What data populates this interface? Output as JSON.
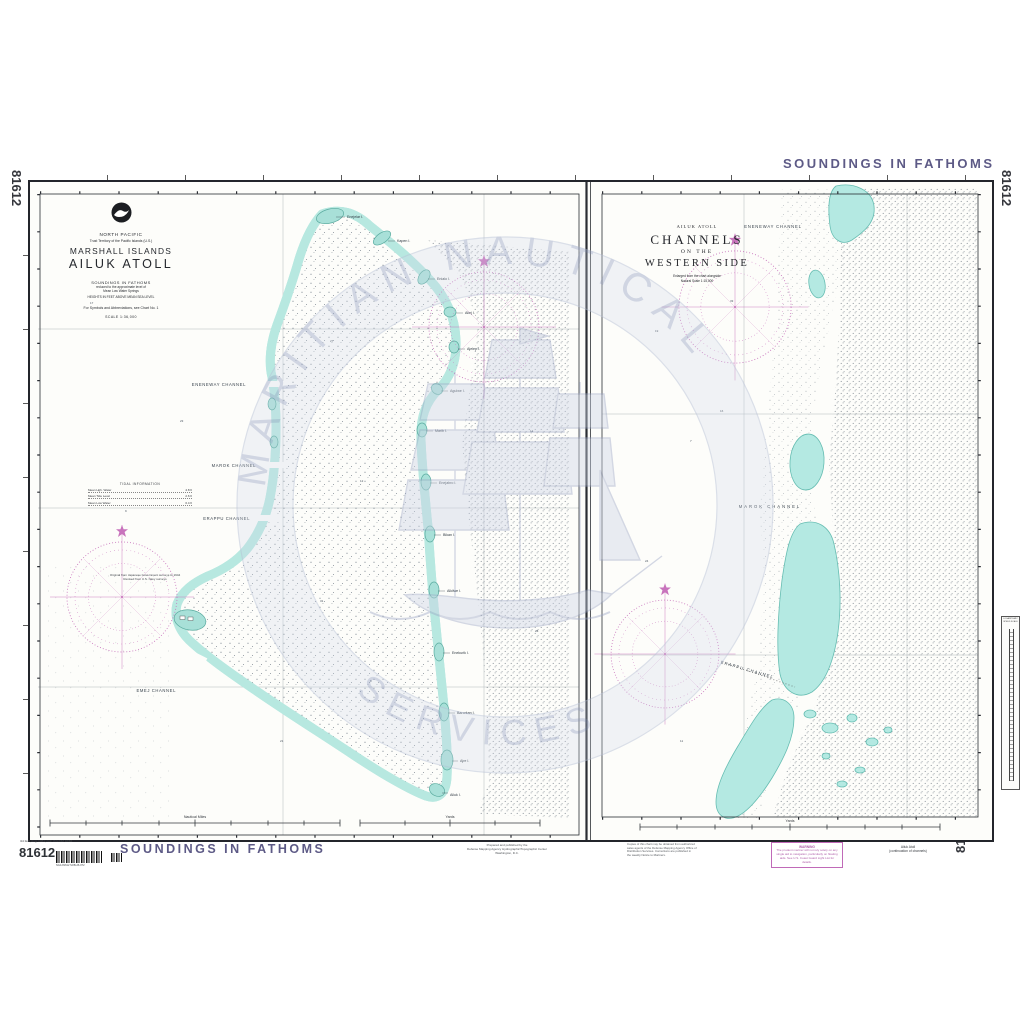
{
  "page": {
    "chart_number": "81612",
    "soundings_top": "SOUNDINGS IN FATHOMS",
    "soundings_bottom": "SOUNDINGS IN FATHOMS",
    "edition_note": "3rd Ed., Aug. 1984; corr. thru NM 32/84",
    "barcode_text": "NGA 81612 SOB-26-072"
  },
  "watermark": {
    "arc_top": "MARITIAN NAUTICAL",
    "arc_bottom": "SERVICES"
  },
  "left_panel": {
    "region": "NORTH PACIFIC",
    "territory": "Trust Territory of the Pacific Islands (U.S.)",
    "island_group": "MARSHALL ISLANDS",
    "title": "AILUK ATOLL",
    "soundings_note": "SOUNDINGS IN FATHOMS",
    "datum_note_1": "reduced to the approximate level of",
    "datum_note_2": "Mean Low Water Springs",
    "heights_note": "HEIGHTS IN FEET ABOVE MEAN SEA LEVEL",
    "symbols_note": "For Symbols and Abbreviations, see Chart No. 1",
    "scale_note": "SCALE 1:36,000",
    "tidal_table": {
      "title": "TIDAL INFORMATION",
      "rows": [
        {
          "label": "Mean Hgh. Water",
          "value": "4.8 ft"
        },
        {
          "label": "Mean Tide Level",
          "value": "2.6 ft"
        },
        {
          "label": "Mean Low Water",
          "value": "0.4 ft"
        }
      ]
    },
    "source_note_1": "Original from Japanese Government surveys to 1944",
    "source_note_2": "Revised from U.S. Navy surveys",
    "channels": [
      "ENENEWAY CHANNEL",
      "MAROK CHANNEL",
      "ERAPPU CHANNEL",
      "EMEJ CHANNEL"
    ],
    "islets": [
      "Enejelar I.",
      "Kapen I.",
      "Enialo I.",
      "Aliej I.",
      "Ajelep I.",
      "Agulwe I.",
      "Marib I.",
      "Enejabro I.",
      "Bikan I.",
      "Alkilwe I.",
      "Enekurik I.",
      "Barorkan I.",
      "Ajre I.",
      "Ailuk I."
    ],
    "scale_bar_1": "Nautical Miles",
    "scale_bar_2": "Yards"
  },
  "right_panel": {
    "atoll": "AILUK ATOLL",
    "title_1": "CHANNELS",
    "title_2": "ON THE",
    "title_3": "WESTERN SIDE",
    "note_1": "Enlarged from the chart alongside",
    "note_2": "Natural Scale 1:15,000",
    "channels": [
      "ENENEWAY CHANNEL",
      "MAROK CHANNEL",
      "ERAPPU CHANNEL"
    ],
    "scale_bar_1": "Yards",
    "side_scale_title": "LOGARITHMIC SPEED SCALE"
  },
  "footer": {
    "publisher_1": "Prepared and published by the",
    "publisher_2": "Defense Mapping Agency Hydrographic/Topographic Center",
    "publisher_3": "Washington, D.C.",
    "repro_note_1": "Copies of this chart may be obtained from authorized",
    "repro_note_2": "sales agents of the Defense Mapping Agency Office of",
    "repro_note_3": "Distribution Services. Corrections are published in",
    "repro_note_4": "the weekly Notice to Mariners.",
    "warning_title": "WARNING",
    "warning_body": "The prudent mariner will not rely solely on any single aid to navigation, particularly on floating aids. See U.S. Coast Guard Light List for details.",
    "continued_1": "Ailuk Atoll",
    "continued_2": "(continuation of channels)"
  },
  "soundings_sample": [
    "17",
    "23",
    "9",
    "27",
    "12",
    "31",
    "8",
    "21",
    "14",
    "26",
    "19",
    "7",
    "24",
    "11",
    "33",
    "16"
  ],
  "colors": {
    "water": "#b7e8e0",
    "reef_edge": "#6fc0b6",
    "magenta": "#c873bc",
    "purple_text": "#5d5a86",
    "ink": "#3c4650"
  }
}
